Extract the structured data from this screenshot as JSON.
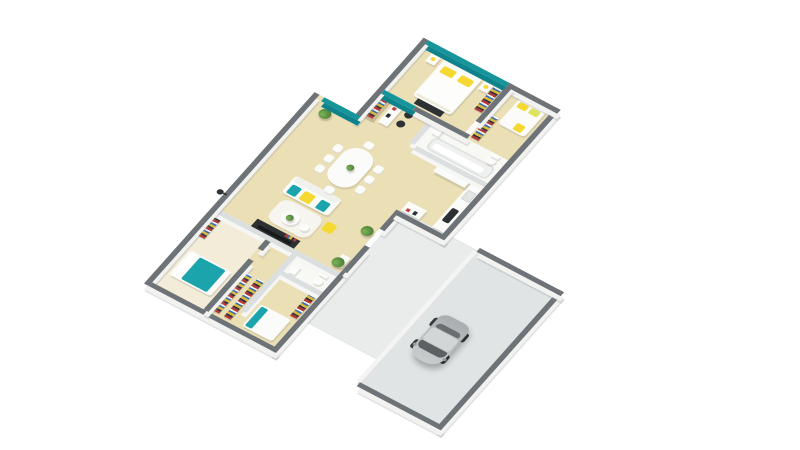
{
  "scene": {
    "type": "isometric-3d-floor-plan",
    "background": "#ffffff",
    "text_content": "none (image contains no rendered text)"
  },
  "palette": {
    "floor": "#ebdfb6",
    "floor_light": "#f2ecd8",
    "bath_floor": "#f8f8f5",
    "terrace": "#e9eceb",
    "garage_floor": "#e0e4e5",
    "wall_cap_dark": "#6d7377",
    "wall_cap_light": "#dcdfe0",
    "wall_face": "#f2f3f1",
    "teal": "#16959d",
    "teal_bright": "#1ba4ac",
    "yellow": "#f6d832",
    "wood": "#d9bf90",
    "dark_furniture": "#2d3133",
    "white_furniture": "#fbfbf9",
    "red_accent": "#c2403c",
    "plant_green": "#5d9442",
    "car_body": "#bcbfc1",
    "car_glass": "#5c6063"
  },
  "rooms": [
    {
      "name": "master-bedroom",
      "features": [
        "teal accent wall",
        "double bed white duvet",
        "2 yellow pillows",
        "2 nightstands with yellow lamps",
        "dark media dresser",
        "wardrobe with colorful clothes"
      ]
    },
    {
      "name": "bedroom-2",
      "features": [
        "double bed",
        "yellow pillows",
        "yellow throw",
        "wardrobe strip"
      ]
    },
    {
      "name": "office-nook",
      "features": [
        "wooden bookshelf with colorful books",
        "white desk",
        "2 dark office chairs",
        "teal wall panel"
      ]
    },
    {
      "name": "bathroom-main",
      "features": [
        "bathtub",
        "sink",
        "toilet"
      ]
    },
    {
      "name": "living-room",
      "features": [
        "white sofa with teal and yellow cushions",
        "ivory rug",
        "round coffee table with plant",
        "dark tv unit",
        "yellow pouf"
      ]
    },
    {
      "name": "dining-area",
      "features": [
        "white table",
        "8 white chairs",
        "green centerpiece"
      ]
    },
    {
      "name": "kitchen",
      "features": [
        "counter with dark cooktop",
        "sink",
        "tall fridge column",
        "island with red accent"
      ]
    },
    {
      "name": "entry-hall",
      "features": [
        "white console",
        "2 potted plants"
      ]
    },
    {
      "name": "bedroom-3",
      "features": [
        "bed with teal duvet",
        "colorful wardrobe shelves"
      ]
    },
    {
      "name": "bedroom-4",
      "features": [
        "bed with teal pillow",
        "colorful shelf"
      ]
    },
    {
      "name": "bathroom-2",
      "features": [
        "toilet",
        "sink"
      ]
    },
    {
      "name": "terrace",
      "features": [
        "light gray slab connecting house to garage"
      ]
    },
    {
      "name": "garage",
      "features": [
        "dark perimeter walls",
        "gray floor",
        "silver car facing west"
      ]
    }
  ],
  "counts": {
    "dining_chairs": 8,
    "plants": 3,
    "bedrooms": 4,
    "bathrooms": 2
  },
  "exterior": {
    "wall_light_fixture": "small dark knob on north facade"
  }
}
